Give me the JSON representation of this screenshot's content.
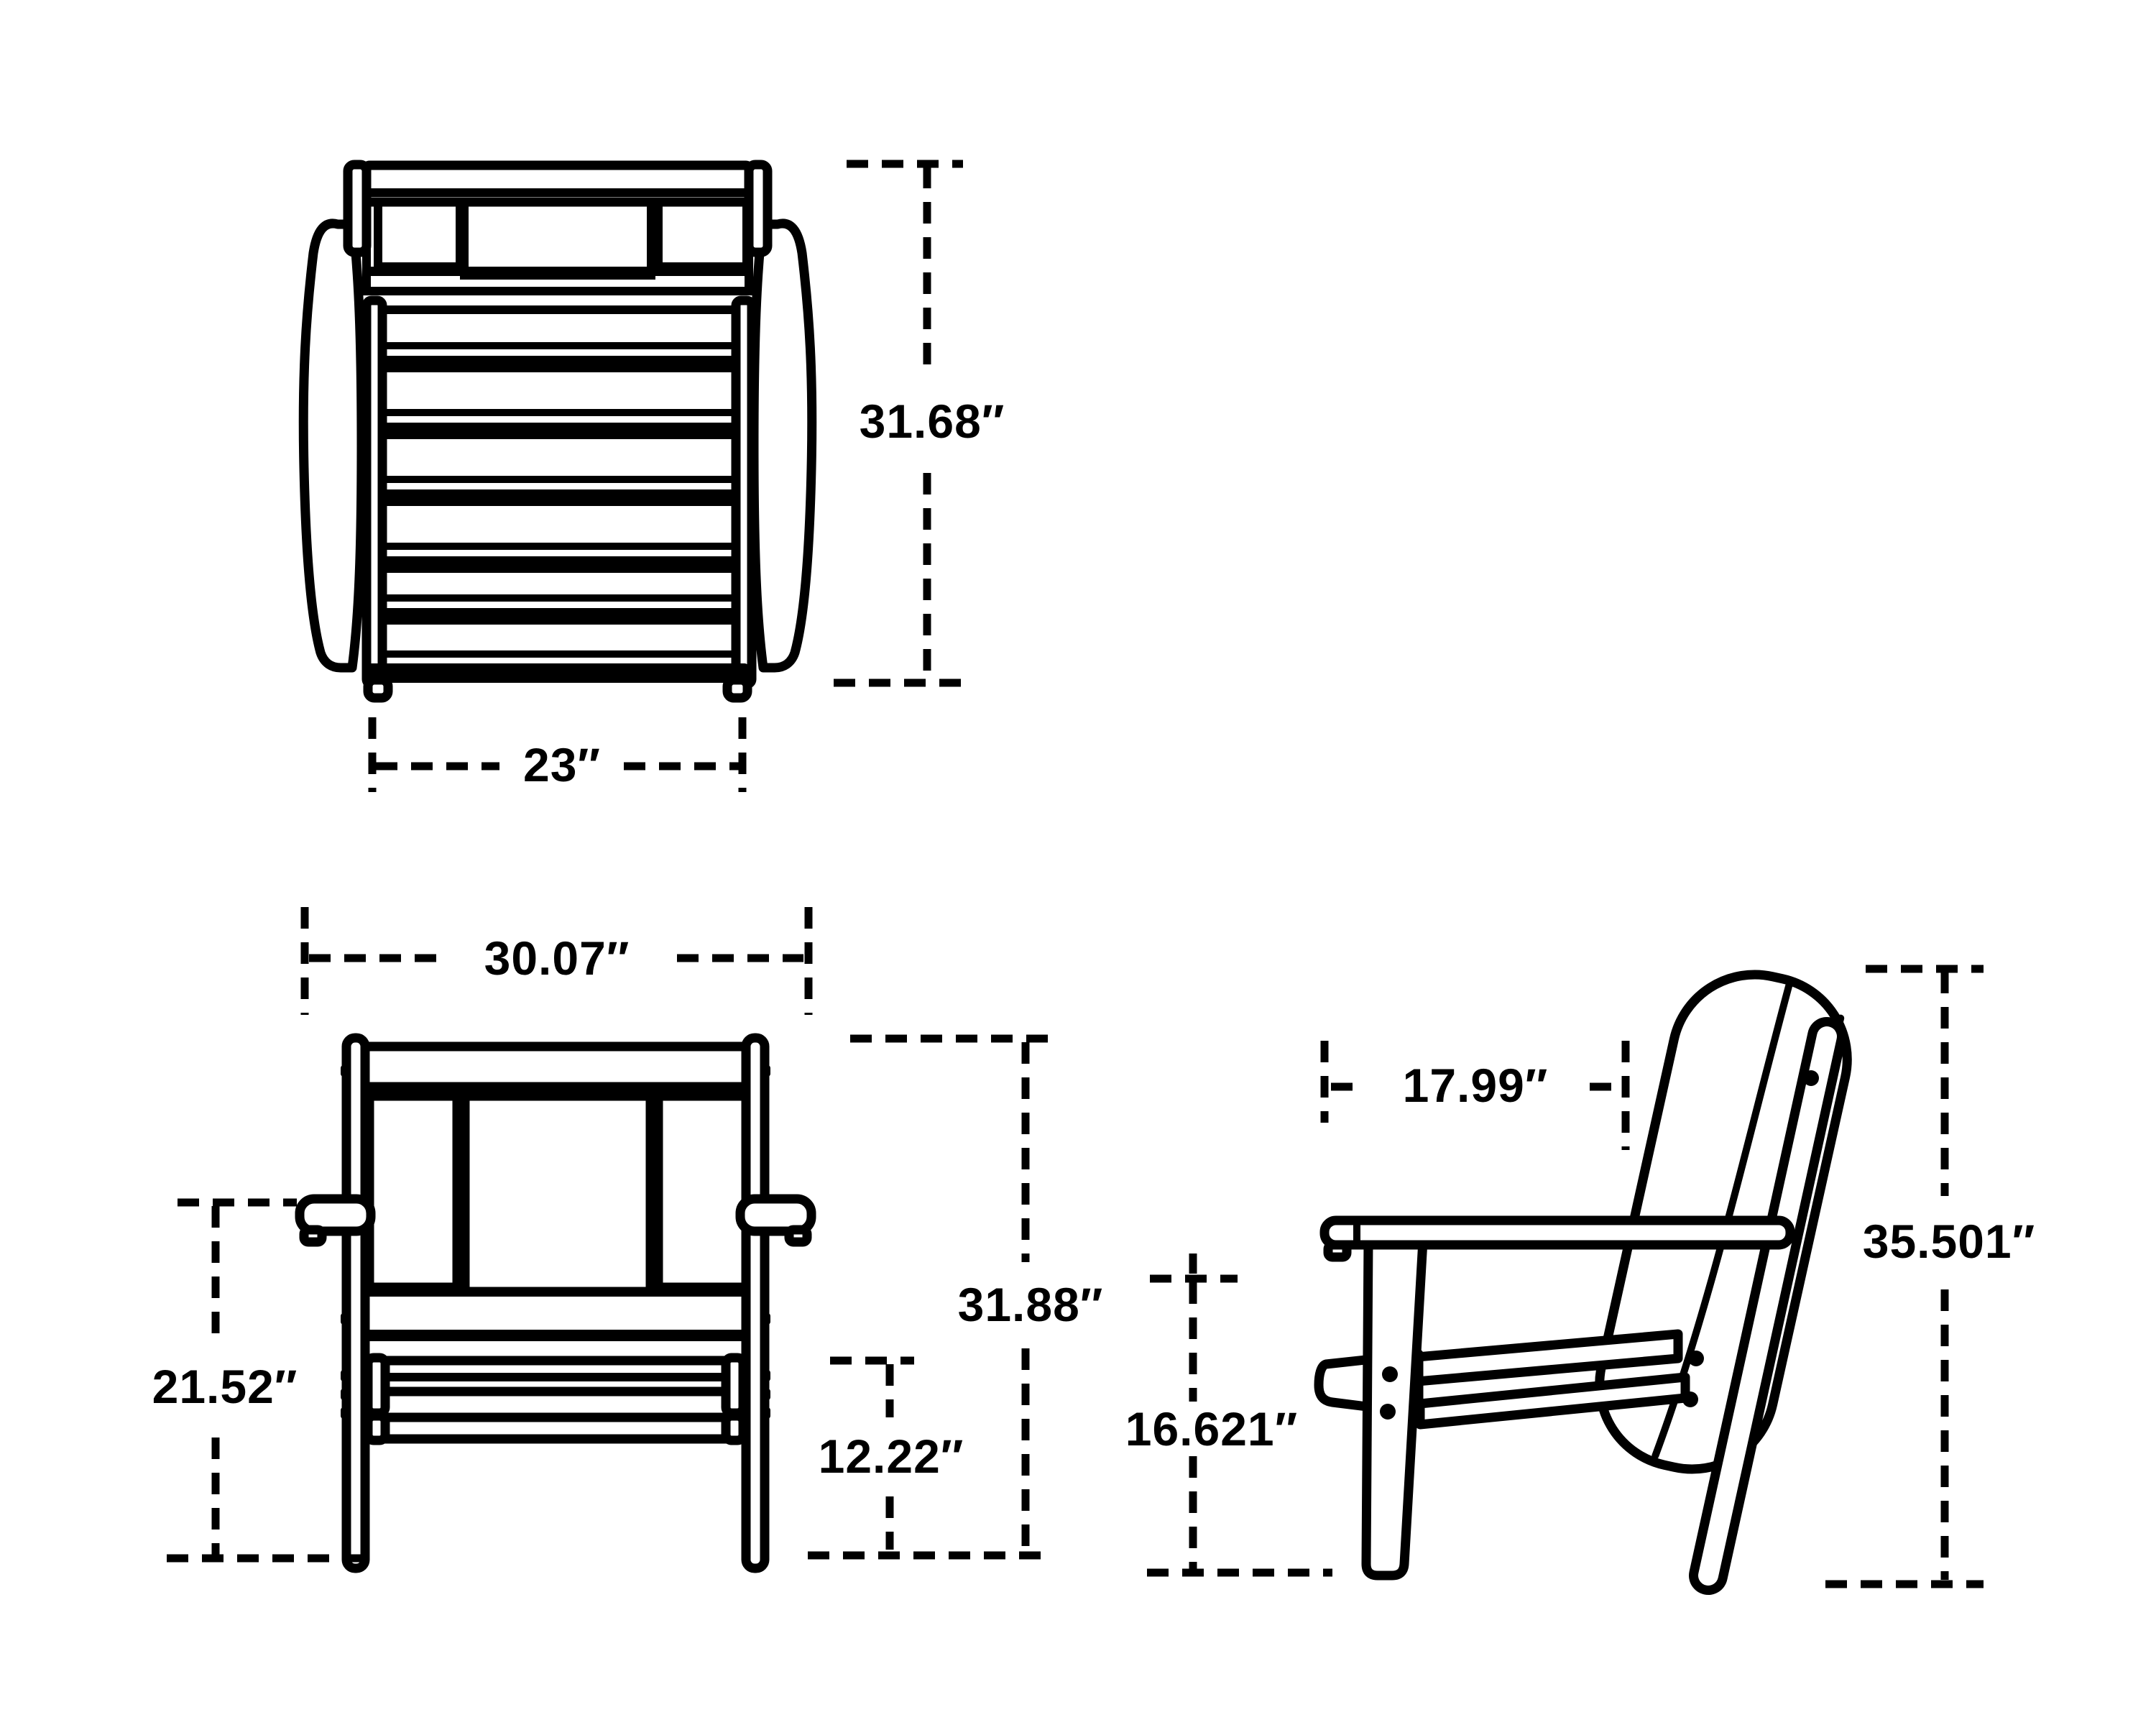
{
  "diagram": {
    "type": "furniture-dimension-drawing",
    "subject": "outdoor lounge chair, three orthographic views with dimension callouts",
    "colors": {
      "line": "#000000",
      "background": "#ffffff"
    },
    "dimensions": {
      "top_height": "31.68″",
      "top_width": "23″",
      "front_width": "30.07″",
      "front_arm_height": "21.52″",
      "front_overall_height": "31.88″",
      "front_seat_height": "12.22″",
      "side_seat_depth": "17.99″",
      "side_overall_height": "35.501″",
      "side_seat_front_height": "16.621″"
    }
  }
}
